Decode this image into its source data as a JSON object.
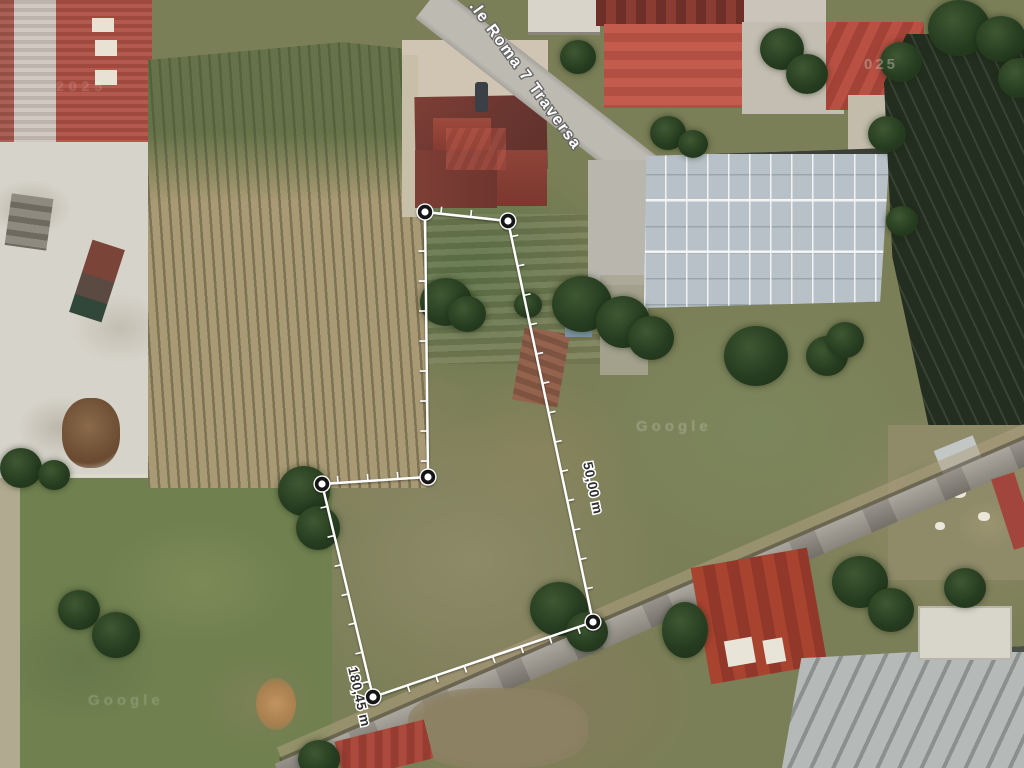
{
  "map": {
    "street_label": ".le Roma 7 Traversa",
    "street_label_pos": {
      "x": 469,
      "y": 6,
      "angle": 54
    },
    "watermarks": [
      {
        "text": "Google"
      },
      {
        "text": "Google"
      },
      {
        "text": "025"
      },
      {
        "text": "2025"
      }
    ],
    "measurement": {
      "line_color": "#ffffff",
      "label_color": "#2f2f2f",
      "halo_color": "#ffffff",
      "vertex_ring_color": "#161616",
      "polygon_px": [
        [
          425,
          212
        ],
        [
          508,
          221
        ],
        [
          593,
          622
        ],
        [
          373,
          697
        ],
        [
          322,
          484
        ],
        [
          428,
          477
        ]
      ],
      "tick_spacing_px": 30,
      "segment_labels": [
        {
          "text": "50,00 m",
          "x": 583,
          "y": 463,
          "angle": 78
        },
        {
          "text": "180,45 m",
          "x": 348,
          "y": 668,
          "angle": 77
        }
      ]
    }
  }
}
